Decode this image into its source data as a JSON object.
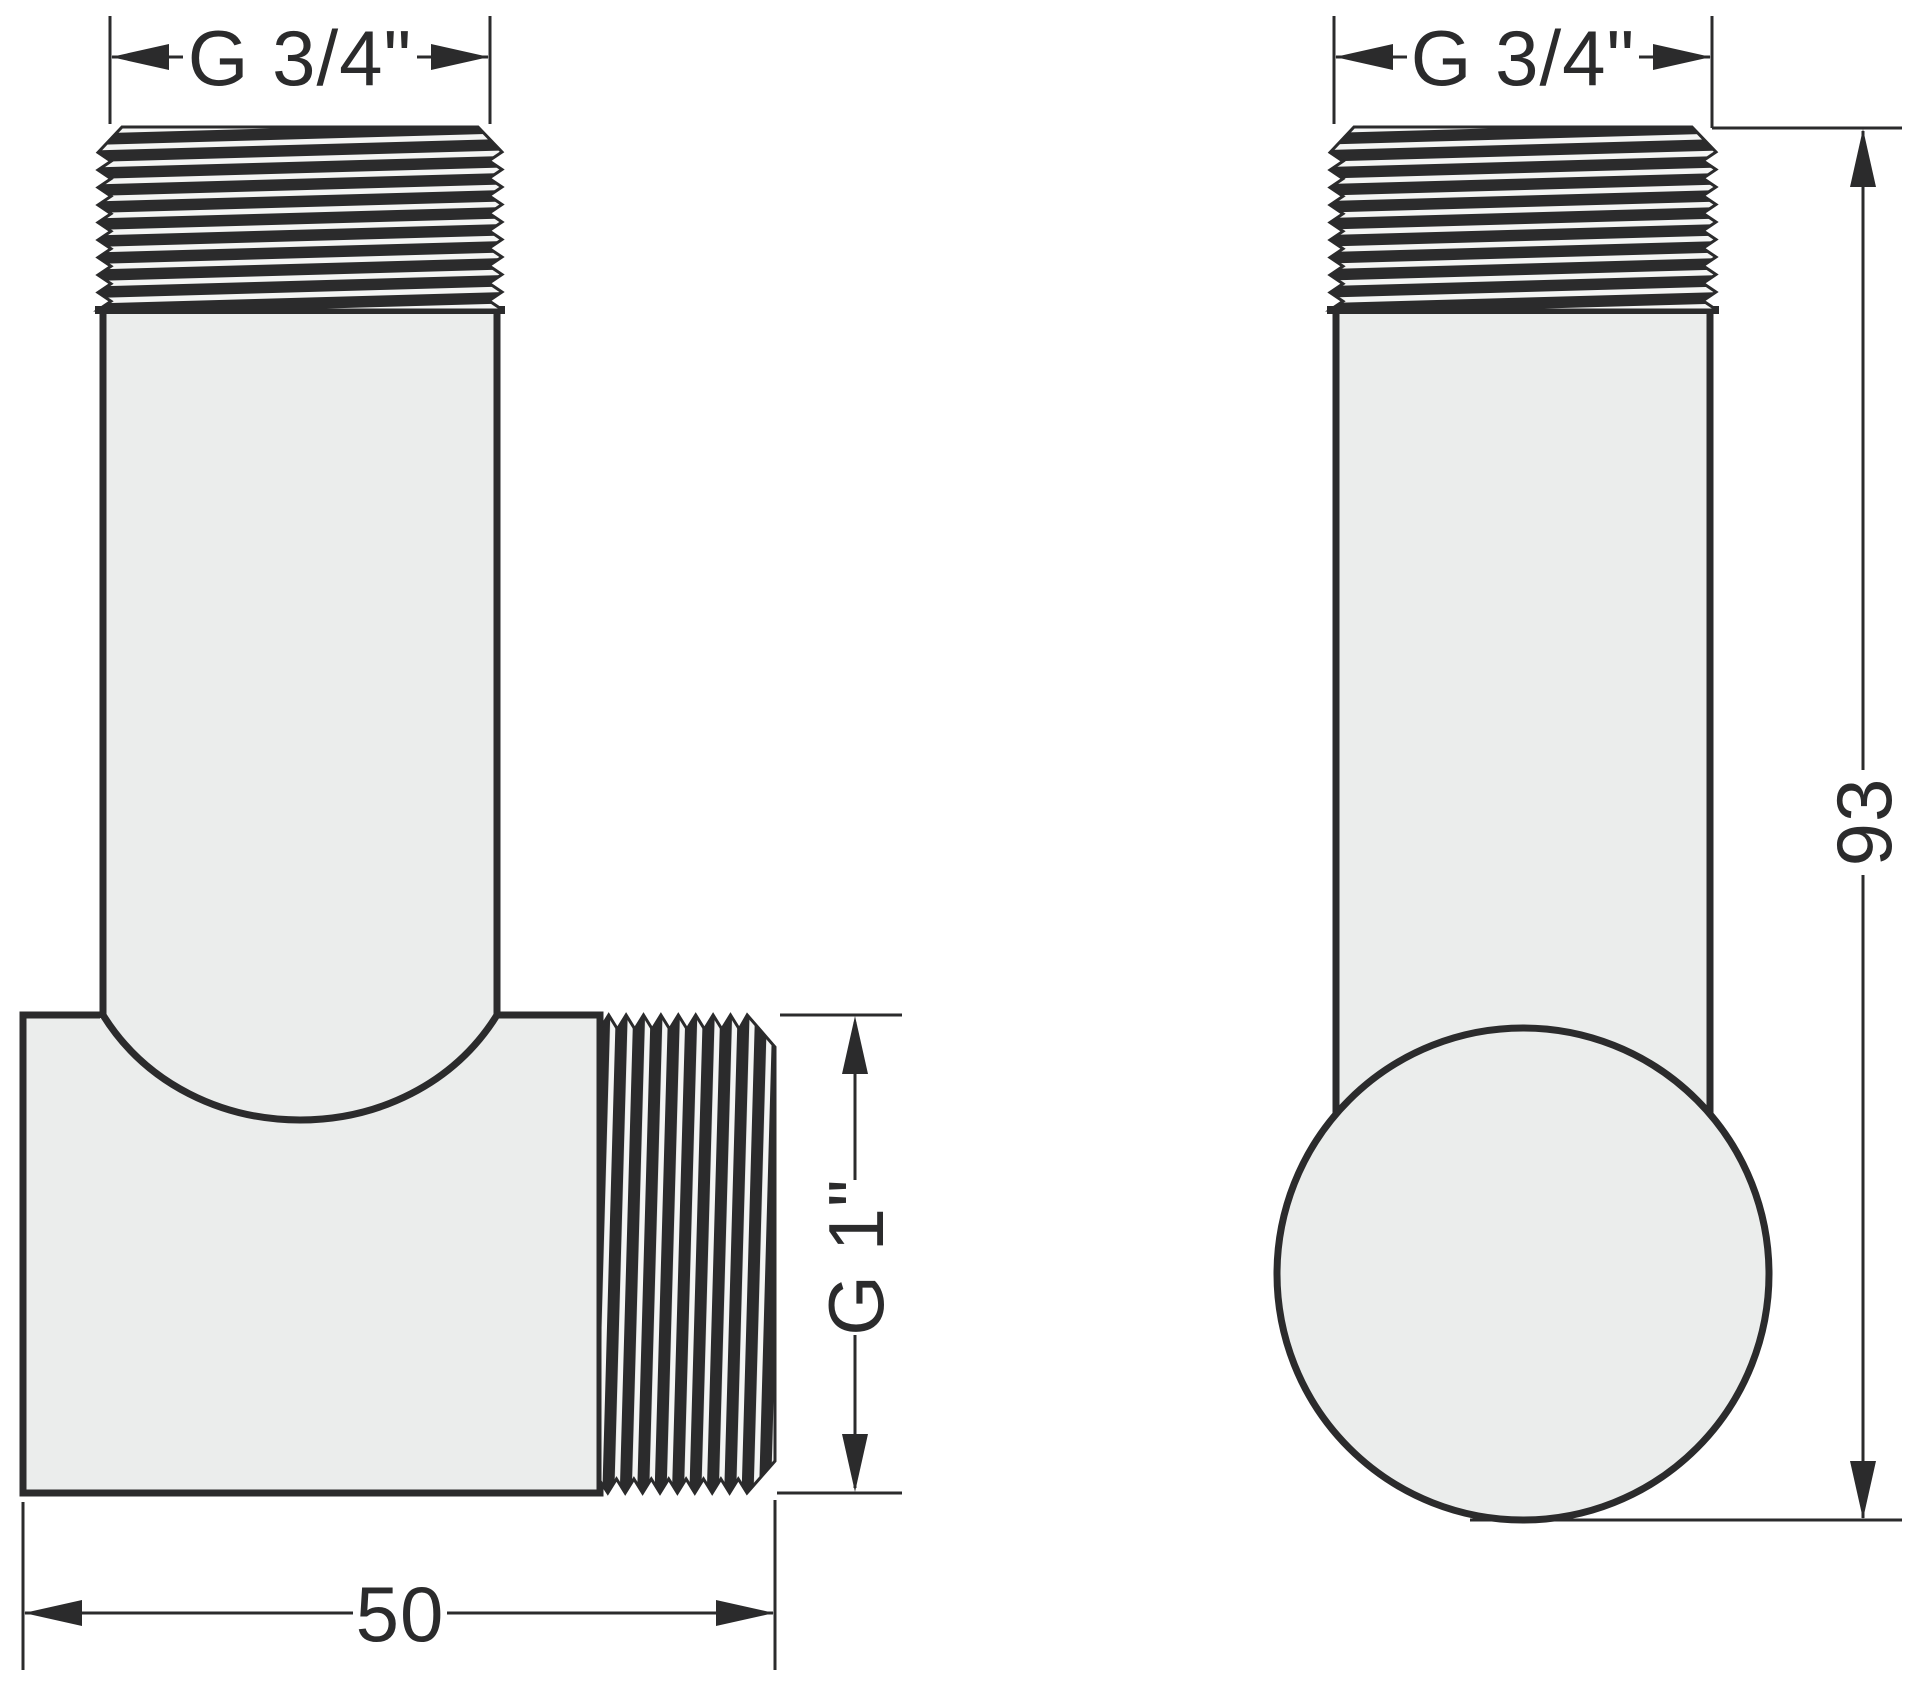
{
  "drawing": {
    "type": "technical-drawing",
    "description": "Two orthographic views of a threaded elbow pipe fitting",
    "colors": {
      "outline": "#2b2b2c",
      "body_fill": "#ebedec",
      "thread_light": "#f4f5f4",
      "background": "#ffffff"
    },
    "views": {
      "front": {
        "dims": {
          "top_thread_label": "G 3/4\"",
          "side_thread_label": "G 1\"",
          "width_label": "50"
        }
      },
      "side": {
        "dims": {
          "top_thread_label": "G 3/4\"",
          "height_label": "93"
        }
      }
    }
  }
}
